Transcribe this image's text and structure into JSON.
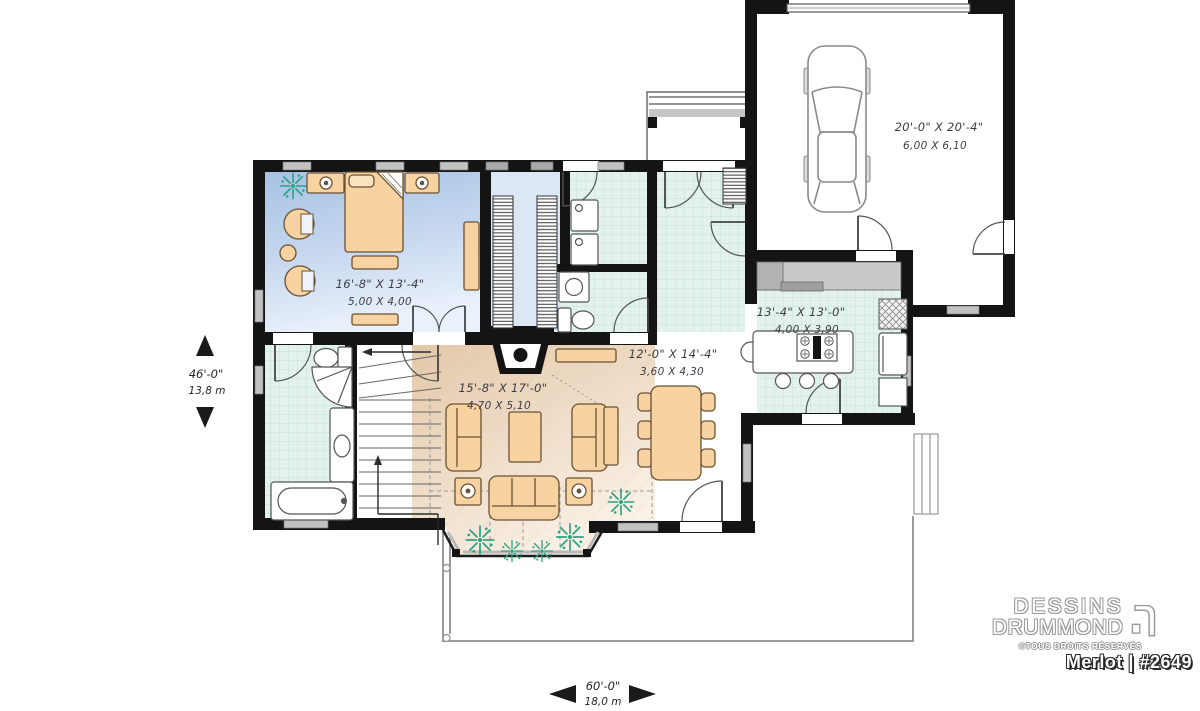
{
  "rooms": {
    "bedroom": {
      "imperial": "16'-8\" X 13'-4\"",
      "metric": "5,00 X 4,00"
    },
    "living_room": {
      "imperial": "15'-8\" X 17'-0\"",
      "metric": "4,70 X 5,10"
    },
    "dining_room": {
      "imperial": "12'-0\" X 14'-4\"",
      "metric": "3,60 X 4,30"
    },
    "kitchen": {
      "imperial": "13'-4\" X 13'-0\"",
      "metric": "4,00 X 3,90"
    },
    "garage": {
      "imperial": "20'-0\" X 20'-4\"",
      "metric": "6,00 X 6,10"
    }
  },
  "dimensions": {
    "depth": {
      "imperial": "46'-0\"",
      "metric": "13,8 m"
    },
    "width": {
      "imperial": "60'-0\"",
      "metric": "18,0 m"
    }
  },
  "branding": {
    "name_line1": "DESSINS",
    "name_line2": "DRUMMOND",
    "rights": "©TOUS DROITS RÉSERVÉS",
    "plan_name": "Merlot | #2649"
  },
  "palette": {
    "wall": "#141414",
    "bedroom_floor": "#a6c2e4",
    "closet_floor": "#dce7f5",
    "tile_floor": "#e3f2ec",
    "living_floor": "#e3c8a9",
    "furniture": "#f6d3a0",
    "counter": "#c9c9c9",
    "plant": "#2ea183",
    "window": "#c2c2c2",
    "deck_line": "#9a9a9a",
    "logo_outline": "#9a9a9a"
  }
}
